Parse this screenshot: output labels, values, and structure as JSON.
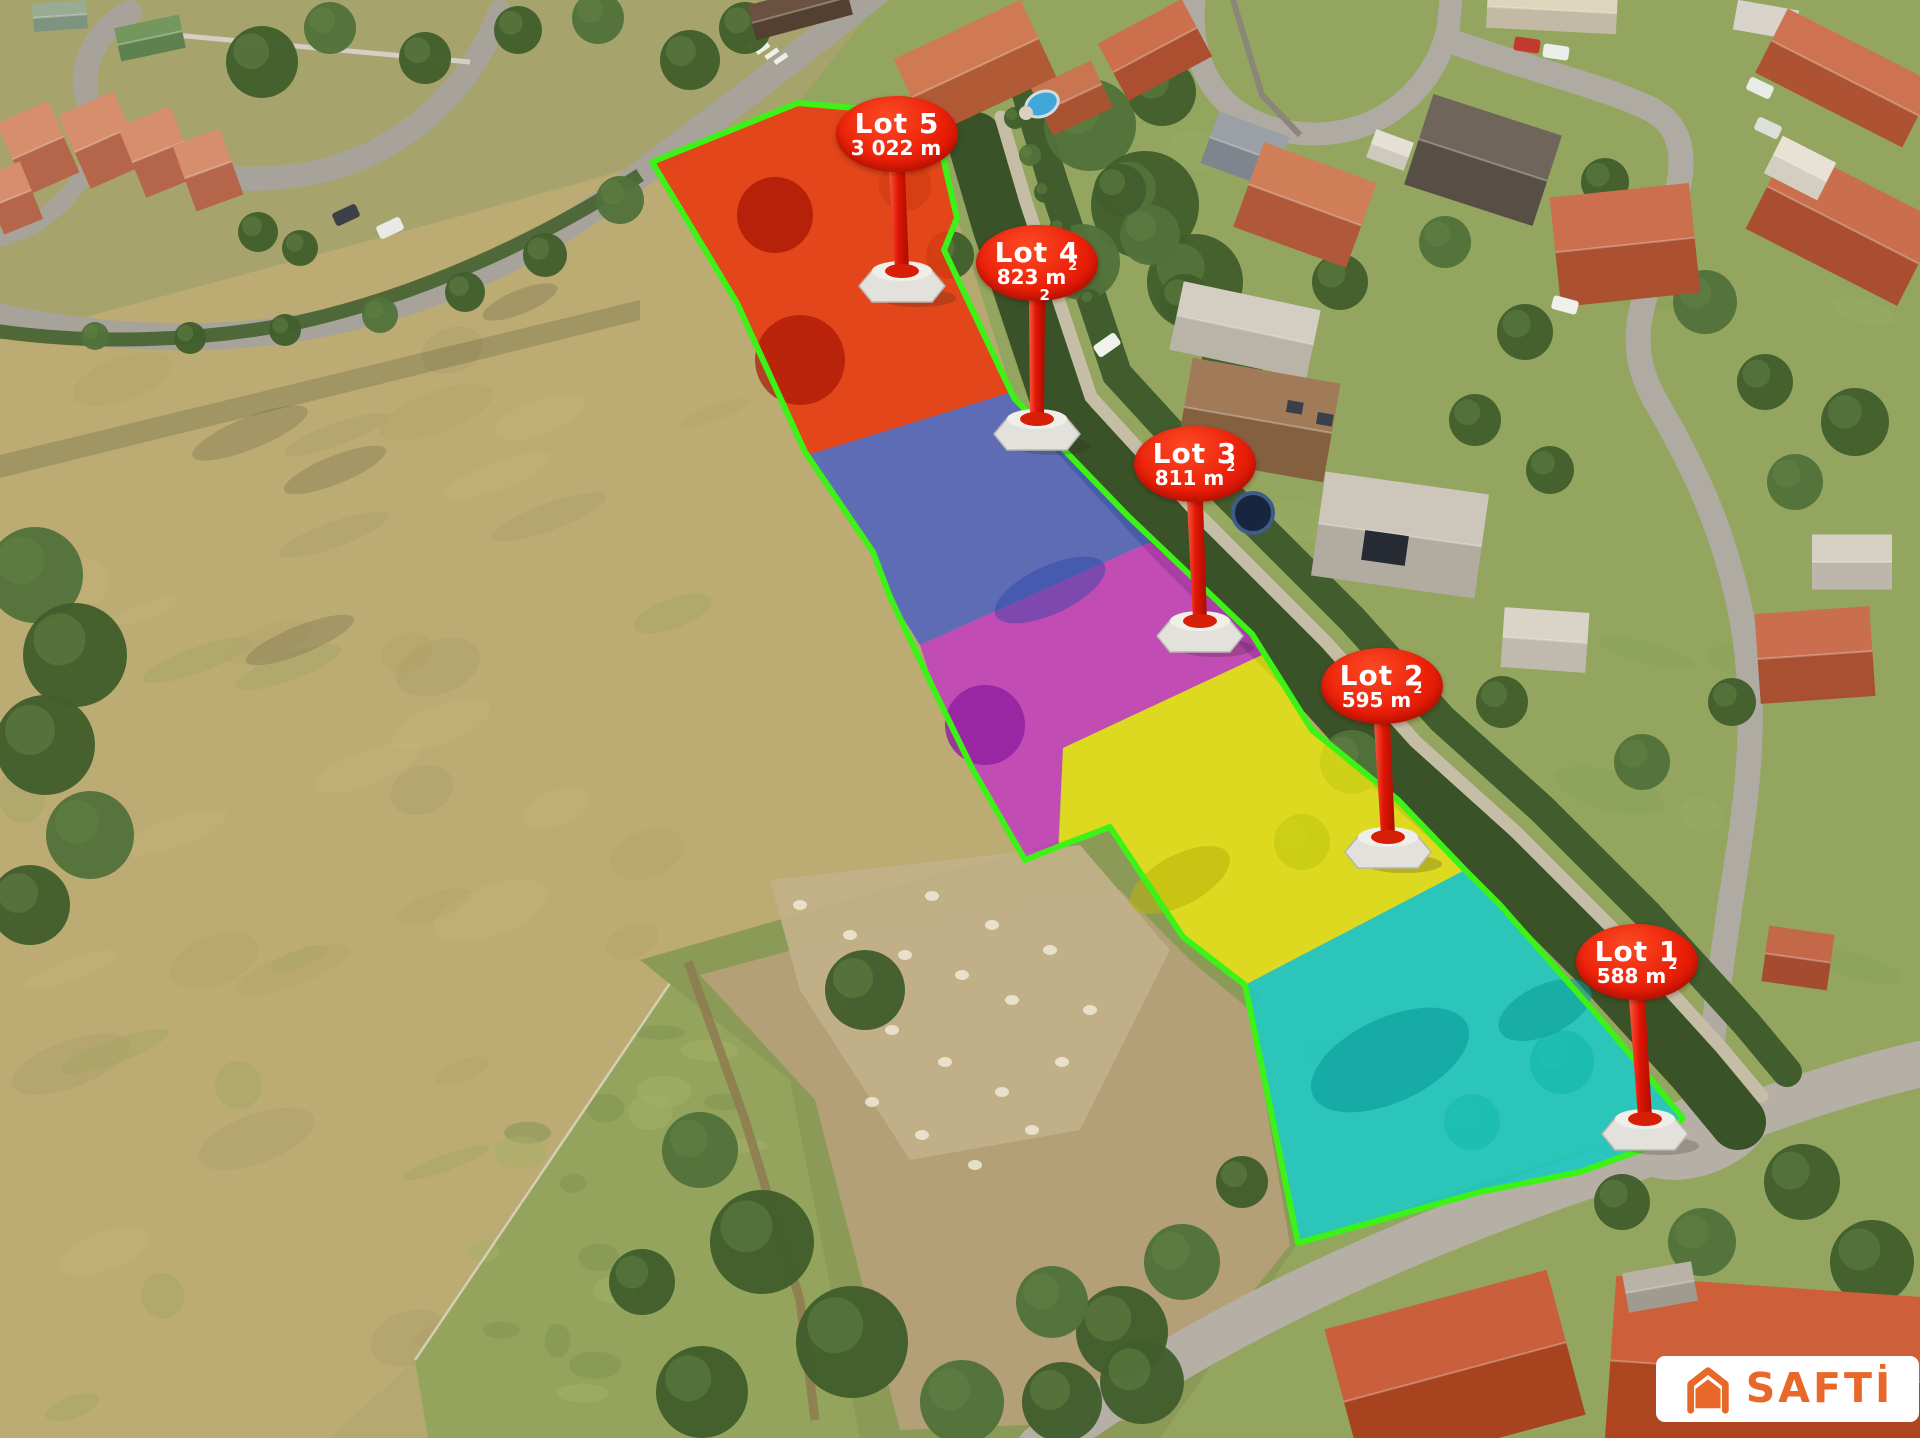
{
  "map": {
    "description": "Aerial subdivision photo with highlighted building lots",
    "outline_color": "#3cf216",
    "marker_color": "#e8230d",
    "lots": [
      {
        "name": "Lot 1",
        "area": "588 m",
        "sup": "2",
        "color": "#18c8c3"
      },
      {
        "name": "Lot 2",
        "area": "595 m",
        "sup": "2",
        "color": "#e4e012"
      },
      {
        "name": "Lot 3",
        "area": "811 m",
        "sup": "2",
        "color": "#c338c2"
      },
      {
        "name": "Lot 4",
        "area": "823 m",
        "sup": "2",
        "stray": "2",
        "color": "#4a5fc4"
      },
      {
        "name": "Lot 5",
        "area": "3 022 m",
        "sup": "",
        "color": "#e8380e"
      }
    ]
  },
  "logo": {
    "text": "SAFTİ",
    "color": "#e8682a",
    "background": "#ffffff"
  }
}
